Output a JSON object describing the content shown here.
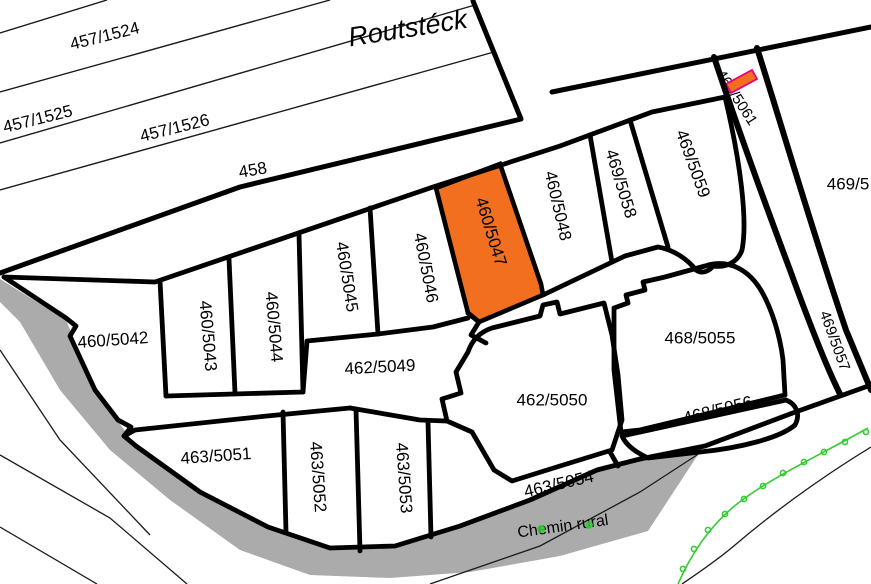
{
  "map": {
    "place_name": "Routstéck",
    "road_name": "Chemin rural",
    "selected_parcel": "460/5047",
    "colors": {
      "selected_fill": "#F26F1F",
      "sliver_fill": "#F26F1F",
      "sliver_stroke": "#E6007E",
      "road_fill": "#ABABAB",
      "marker_green": "#33CC33",
      "boundary": "#000000",
      "road_text": "#3C3C3C"
    },
    "labels": [
      {
        "name": "parcel-label-457-1524",
        "text": "457/1524",
        "x": 105,
        "y": 37,
        "rot": -14,
        "size": 17,
        "layer": "over"
      },
      {
        "name": "parcel-label-457-1525",
        "text": "457/1525",
        "x": 38,
        "y": 120,
        "rot": -14,
        "size": 17,
        "layer": "over"
      },
      {
        "name": "parcel-label-457-1526",
        "text": "457/1526",
        "x": 175,
        "y": 129,
        "rot": -14,
        "size": 17,
        "layer": "over"
      },
      {
        "name": "parcel-label-458",
        "text": "458",
        "x": 253,
        "y": 171,
        "rot": -10,
        "size": 17,
        "layer": "over"
      },
      {
        "name": "place-name-label",
        "text": "Routstéck",
        "x": 408,
        "y": 30,
        "rot": -9,
        "size": 27,
        "italic": true,
        "layer": "over"
      },
      {
        "name": "parcel-label-460-5042",
        "text": "460/5042",
        "x": 113,
        "y": 341,
        "rot": -4,
        "size": 17,
        "layer": "over"
      },
      {
        "name": "parcel-label-460-5043",
        "text": "460/5043",
        "x": 207,
        "y": 336,
        "rot": 85,
        "size": 17,
        "layer": "over"
      },
      {
        "name": "parcel-label-460-5044",
        "text": "460/5044",
        "x": 273,
        "y": 327,
        "rot": 85,
        "size": 17,
        "layer": "over"
      },
      {
        "name": "parcel-label-460-5045",
        "text": "460/5045",
        "x": 346,
        "y": 277,
        "rot": 81,
        "size": 17,
        "layer": "over"
      },
      {
        "name": "parcel-label-460-5046",
        "text": "460/5046",
        "x": 425,
        "y": 268,
        "rot": 79,
        "size": 17,
        "layer": "over"
      },
      {
        "name": "parcel-label-460-5047",
        "text": "460/5047",
        "x": 490,
        "y": 232,
        "rot": 73,
        "size": 17,
        "layer": "over",
        "color": "#1a1a1a"
      },
      {
        "name": "parcel-label-460-5048",
        "text": "460/5048",
        "x": 557,
        "y": 206,
        "rot": 77,
        "size": 17,
        "layer": "over"
      },
      {
        "name": "parcel-label-469-5058",
        "text": "469/5058",
        "x": 620,
        "y": 184,
        "rot": 73,
        "size": 17,
        "layer": "over"
      },
      {
        "name": "parcel-label-469-5059",
        "text": "469/5059",
        "x": 692,
        "y": 164,
        "rot": 70,
        "size": 17,
        "layer": "over"
      },
      {
        "name": "parcel-label-469-5061",
        "text": "469/5061",
        "x": 736,
        "y": 98,
        "rot": 57,
        "size": 15,
        "layer": "under"
      },
      {
        "name": "parcel-label-469-5-clipped",
        "text": "469/5",
        "x": 848,
        "y": 185,
        "rot": 0,
        "size": 17,
        "layer": "over"
      },
      {
        "name": "parcel-label-469-5057",
        "text": "469/5057",
        "x": 834,
        "y": 341,
        "rot": 70,
        "size": 15,
        "layer": "under"
      },
      {
        "name": "parcel-label-462-5049",
        "text": "462/5049",
        "x": 380,
        "y": 368,
        "rot": -3,
        "size": 17,
        "layer": "over"
      },
      {
        "name": "parcel-label-462-5050",
        "text": "462/5050",
        "x": 552,
        "y": 401,
        "rot": 0,
        "size": 17,
        "layer": "over"
      },
      {
        "name": "parcel-label-468-5055",
        "text": "468/5055",
        "x": 700,
        "y": 339,
        "rot": 0,
        "size": 17,
        "layer": "over"
      },
      {
        "name": "parcel-label-468-5056",
        "text": "468/5056",
        "x": 718,
        "y": 411,
        "rot": -14,
        "size": 17,
        "layer": "over"
      },
      {
        "name": "parcel-label-463-5051",
        "text": "463/5051",
        "x": 216,
        "y": 457,
        "rot": -4,
        "size": 17,
        "layer": "over"
      },
      {
        "name": "parcel-label-463-5052",
        "text": "463/5052",
        "x": 317,
        "y": 477,
        "rot": 86,
        "size": 17,
        "layer": "over"
      },
      {
        "name": "parcel-label-463-5053",
        "text": "463/5053",
        "x": 403,
        "y": 478,
        "rot": 86,
        "size": 17,
        "layer": "over"
      },
      {
        "name": "parcel-label-463-5054",
        "text": "463/5054",
        "x": 559,
        "y": 485,
        "rot": -13,
        "size": 17,
        "layer": "over"
      },
      {
        "name": "road-name-label",
        "text": "Chemin rural",
        "x": 563,
        "y": 527,
        "rot": -8,
        "size": 16,
        "layer": "over",
        "color": "#3C3C3C"
      }
    ],
    "green_markers": [
      [
        866,
        432
      ],
      [
        845,
        442
      ],
      [
        824,
        452
      ],
      [
        804,
        462
      ],
      [
        783,
        473
      ],
      [
        763,
        486
      ],
      [
        744,
        499
      ],
      [
        725,
        514
      ],
      [
        708,
        530
      ],
      [
        694,
        549
      ],
      [
        683,
        569
      ]
    ],
    "text_dots": [
      [
        541,
        529
      ],
      [
        589,
        525
      ]
    ]
  }
}
